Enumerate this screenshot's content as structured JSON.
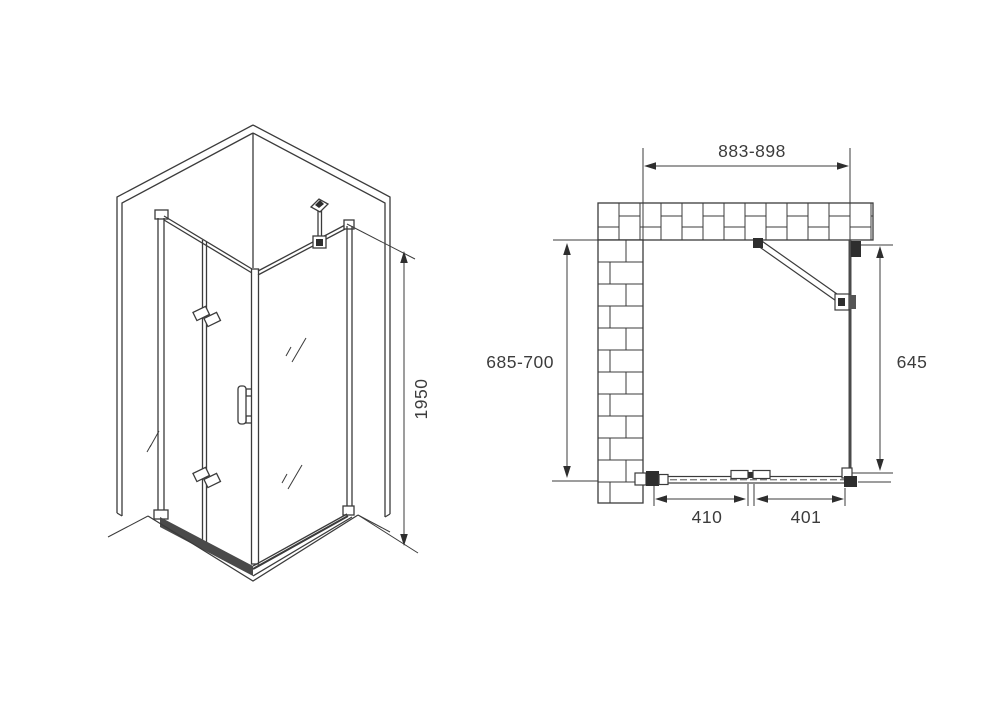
{
  "colors": {
    "background": "#ffffff",
    "line": "#3b3b3b",
    "dark_fill": "#2e2e2e"
  },
  "perspective_view": {
    "height_dimension": {
      "label": "1950"
    }
  },
  "plan_view": {
    "top_width": {
      "label": "883-898"
    },
    "left_depth": {
      "label": "685-700"
    },
    "right_depth": {
      "label": "645"
    },
    "door_panel_left": {
      "label": "410"
    },
    "door_panel_right": {
      "label": "401"
    }
  }
}
